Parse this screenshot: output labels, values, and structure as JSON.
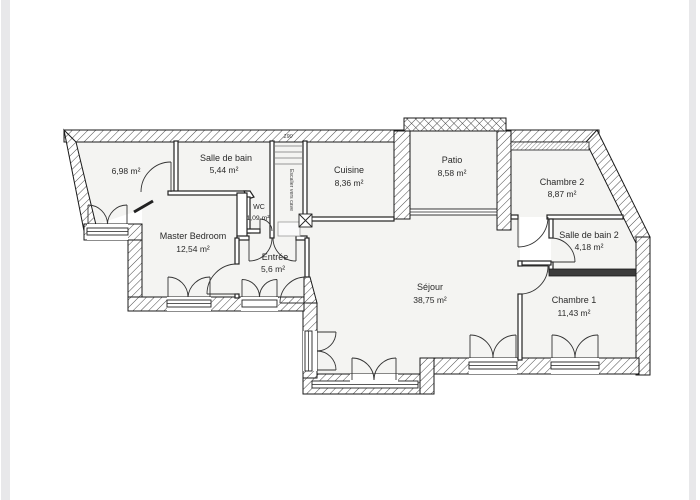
{
  "page": {
    "edge_band_color": "#e8e8ea",
    "canvas_color": "#ffffff",
    "floor_color": "#f4f4f2",
    "wall_line_color": "#1a1a1a"
  },
  "plan": {
    "rooms": {
      "unnamed_left": {
        "name": "",
        "area": "6,98 m²"
      },
      "salle_de_bain": {
        "name": "Salle de bain",
        "area": "5,44 m²"
      },
      "cuisine": {
        "name": "Cuisine",
        "area": "8,36 m²"
      },
      "patio": {
        "name": "Patio",
        "area": "8,58 m²"
      },
      "chambre_2": {
        "name": "Chambre 2",
        "area": "8,87 m²"
      },
      "wc": {
        "name": "WC",
        "area": "1,09 m²"
      },
      "master_bedroom": {
        "name": "Master Bedroom",
        "area": "12,54 m²"
      },
      "entree": {
        "name": "Entrée",
        "area": "5,6 m²"
      },
      "sejour": {
        "name": "Séjour",
        "area": "38,75 m²"
      },
      "salle_de_bain_2": {
        "name": "Salle de bain 2",
        "area": "4,18 m²"
      },
      "chambre_1": {
        "name": "Chambre 1",
        "area": "11,43 m²"
      }
    },
    "annotations": {
      "stairs": "Escalier vers cave",
      "dim_top": "190"
    }
  }
}
